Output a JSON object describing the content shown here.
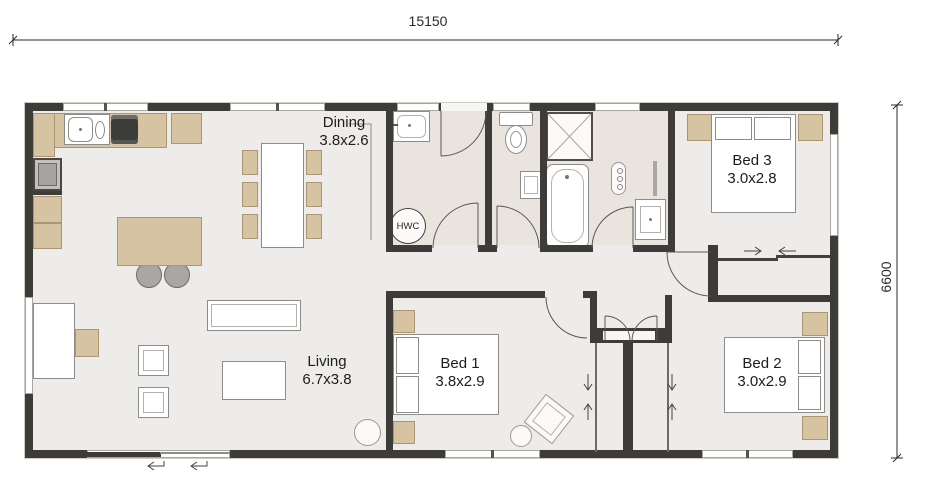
{
  "plan": {
    "dimensions": {
      "top": "15150",
      "right": "6600"
    },
    "rooms": {
      "dining": {
        "name": "Dining",
        "size": "3.8x2.6"
      },
      "living": {
        "name": "Living",
        "size": "6.7x3.8"
      },
      "bed1": {
        "name": "Bed 1",
        "size": "3.8x2.9"
      },
      "bed2": {
        "name": "Bed 2",
        "size": "3.0x2.9"
      },
      "bed3": {
        "name": "Bed 3",
        "size": "3.0x2.8"
      }
    },
    "fixtures": {
      "hwc_label": "HWC"
    },
    "colors": {
      "wall": "#3e3c39",
      "floor": "#edecea",
      "wet_floor": "#e9e5de",
      "timber": "#d6c3a2",
      "fixture_white": "#ffffff",
      "linework": "#555555"
    }
  }
}
